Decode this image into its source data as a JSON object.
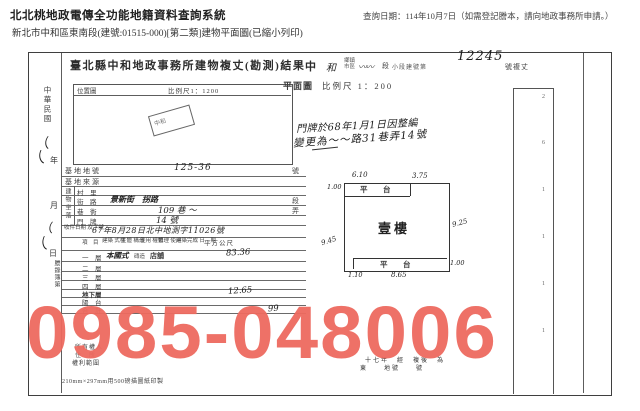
{
  "header": {
    "system_title": "北北桃地政電傳全功能地籍資料查詢系統",
    "query_note": "查詢日期：114年10月7日（如需登記謄本，請向地政事務所申請。）",
    "subtitle": "新北市中和區東南段(建號:01515-000)[第二類]建物平面圖(已縮小列印)"
  },
  "doc": {
    "title": "臺北縣中和地政事務所建物複丈(勘測)結果",
    "margin": {
      "era": "中華民國",
      "year": "年",
      "month": "月",
      "day": "日",
      "ledger": "謄錄簿第",
      "marks": [
        "（",
        "（",
        "（",
        "（"
      ]
    },
    "locmap": {
      "label": "位置圖",
      "scale": "比例尺1：1200",
      "stamp": "中和"
    },
    "hdr_right": {
      "c1": "中",
      "c2": "和",
      "small1": "鄉鎮\n市區",
      "scribble": "〰〰",
      "duan": "段",
      "small2": "小段建號第",
      "number": "12245",
      "suffix": "號複丈",
      "plan": "平面圖",
      "plan_scale": "比例尺 1：200",
      "note1": "門牌於68年1月1日因整編",
      "note2": "變更為〜〜路31巷弄14號"
    },
    "form": {
      "row_landno": {
        "label": "基地地號",
        "value": "125-36",
        "edge": "號"
      },
      "row_landsrc": {
        "label": "基地來源"
      },
      "vlabel": "建物坐落",
      "row_village": {
        "label": "村　里"
      },
      "row_street": {
        "label": "街　路",
        "value": "景新街　拐路",
        "edge": "段"
      },
      "row_lane": {
        "label": "巷　衖",
        "value": "109 巷 〜",
        "edge": "弄"
      },
      "row_door": {
        "label": "門　牌",
        "value": "14 號"
      },
      "row_receipt": {
        "label": "收件日期\n及字號",
        "value": "67年8月28日北中地測字11026號"
      },
      "table": {
        "headers": [
          "項　目",
          "建築\n式樣",
          "主體\n構造",
          "使用\n權類",
          "管理\n使用",
          "建築完成\n日　期",
          "平方公尺"
        ],
        "rows": [
          {
            "label": "一　層",
            "style": "本國式",
            "structure": "磚造",
            "use": "店舖",
            "area": "83.36"
          },
          {
            "label": "二　層",
            "area": ""
          },
          {
            "label": "三　層",
            "area": ""
          },
          {
            "label": "四　層",
            "area": ""
          },
          {
            "label": "地下層",
            "area": "12.65"
          },
          {
            "label": "陽　台",
            "area": ""
          },
          {
            "label": "合　計",
            "area": "99"
          }
        ]
      },
      "owner": "所有權人",
      "owner_addr": "住　所",
      "owner_scope": "權利範圍",
      "print_spec": "210mm×297mm用500磅描圖紙印製",
      "note_br1": "十七年　經　複後　為",
      "note_br2": "東　　地號　　號"
    },
    "floorplan": {
      "room": "壹樓",
      "top_platform": "平　台",
      "bottom_platform": "平　台",
      "dim_top_left": "6.10",
      "dim_top_right": "3.75",
      "dim_left_small": "1.00",
      "dim_left": "9.45",
      "dim_right": "9.25",
      "dim_bottom": "8.65",
      "dim_bottom_left": "1.10",
      "dim_bottom_right": "1.00"
    },
    "strip_marks": [
      "2",
      "6",
      "1",
      "1",
      "1",
      "1"
    ]
  },
  "watermark": {
    "text": "0985-048006",
    "color": "#ee6a5f"
  }
}
